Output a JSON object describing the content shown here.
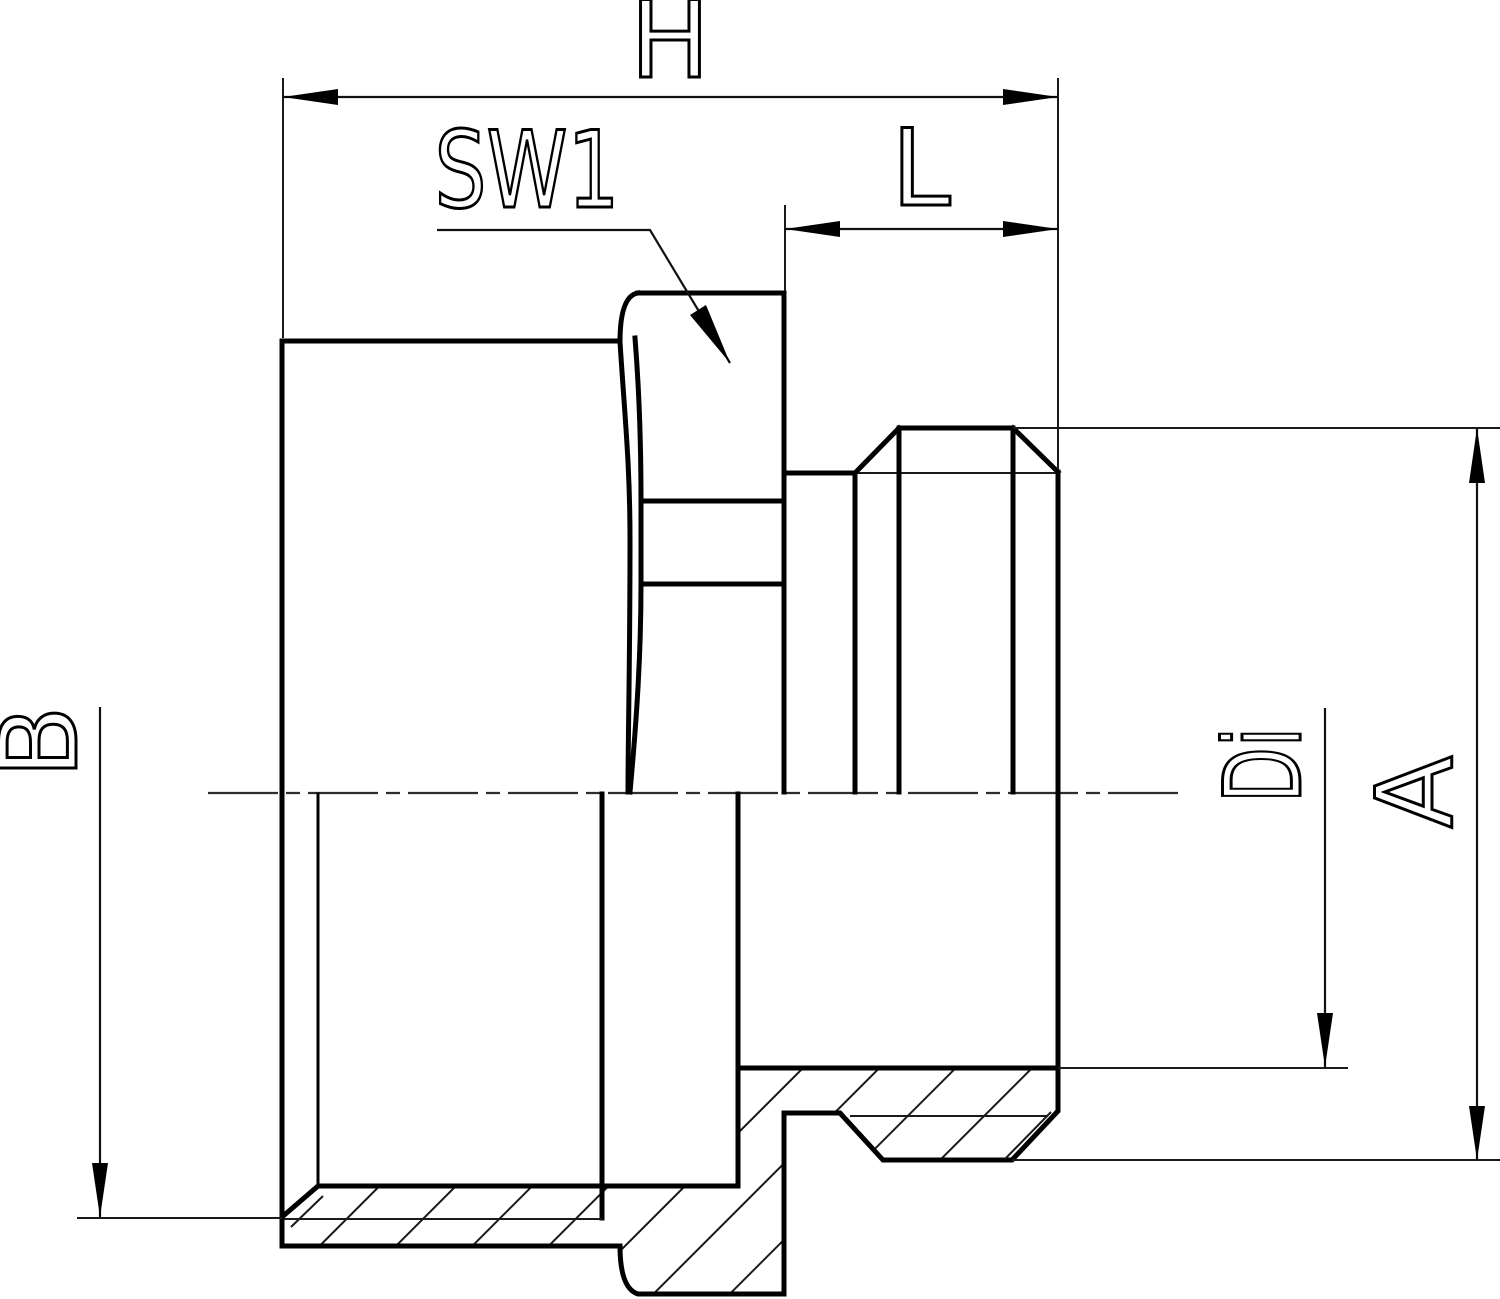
{
  "drawing": {
    "background_color": "#ffffff",
    "line_color": "#000000",
    "labels": {
      "overall_length": "H",
      "wrench_size": "SW1",
      "thread_length": "L",
      "female_diameter": "B",
      "inner_diameter": "Di",
      "outer_diameter": "A"
    }
  }
}
